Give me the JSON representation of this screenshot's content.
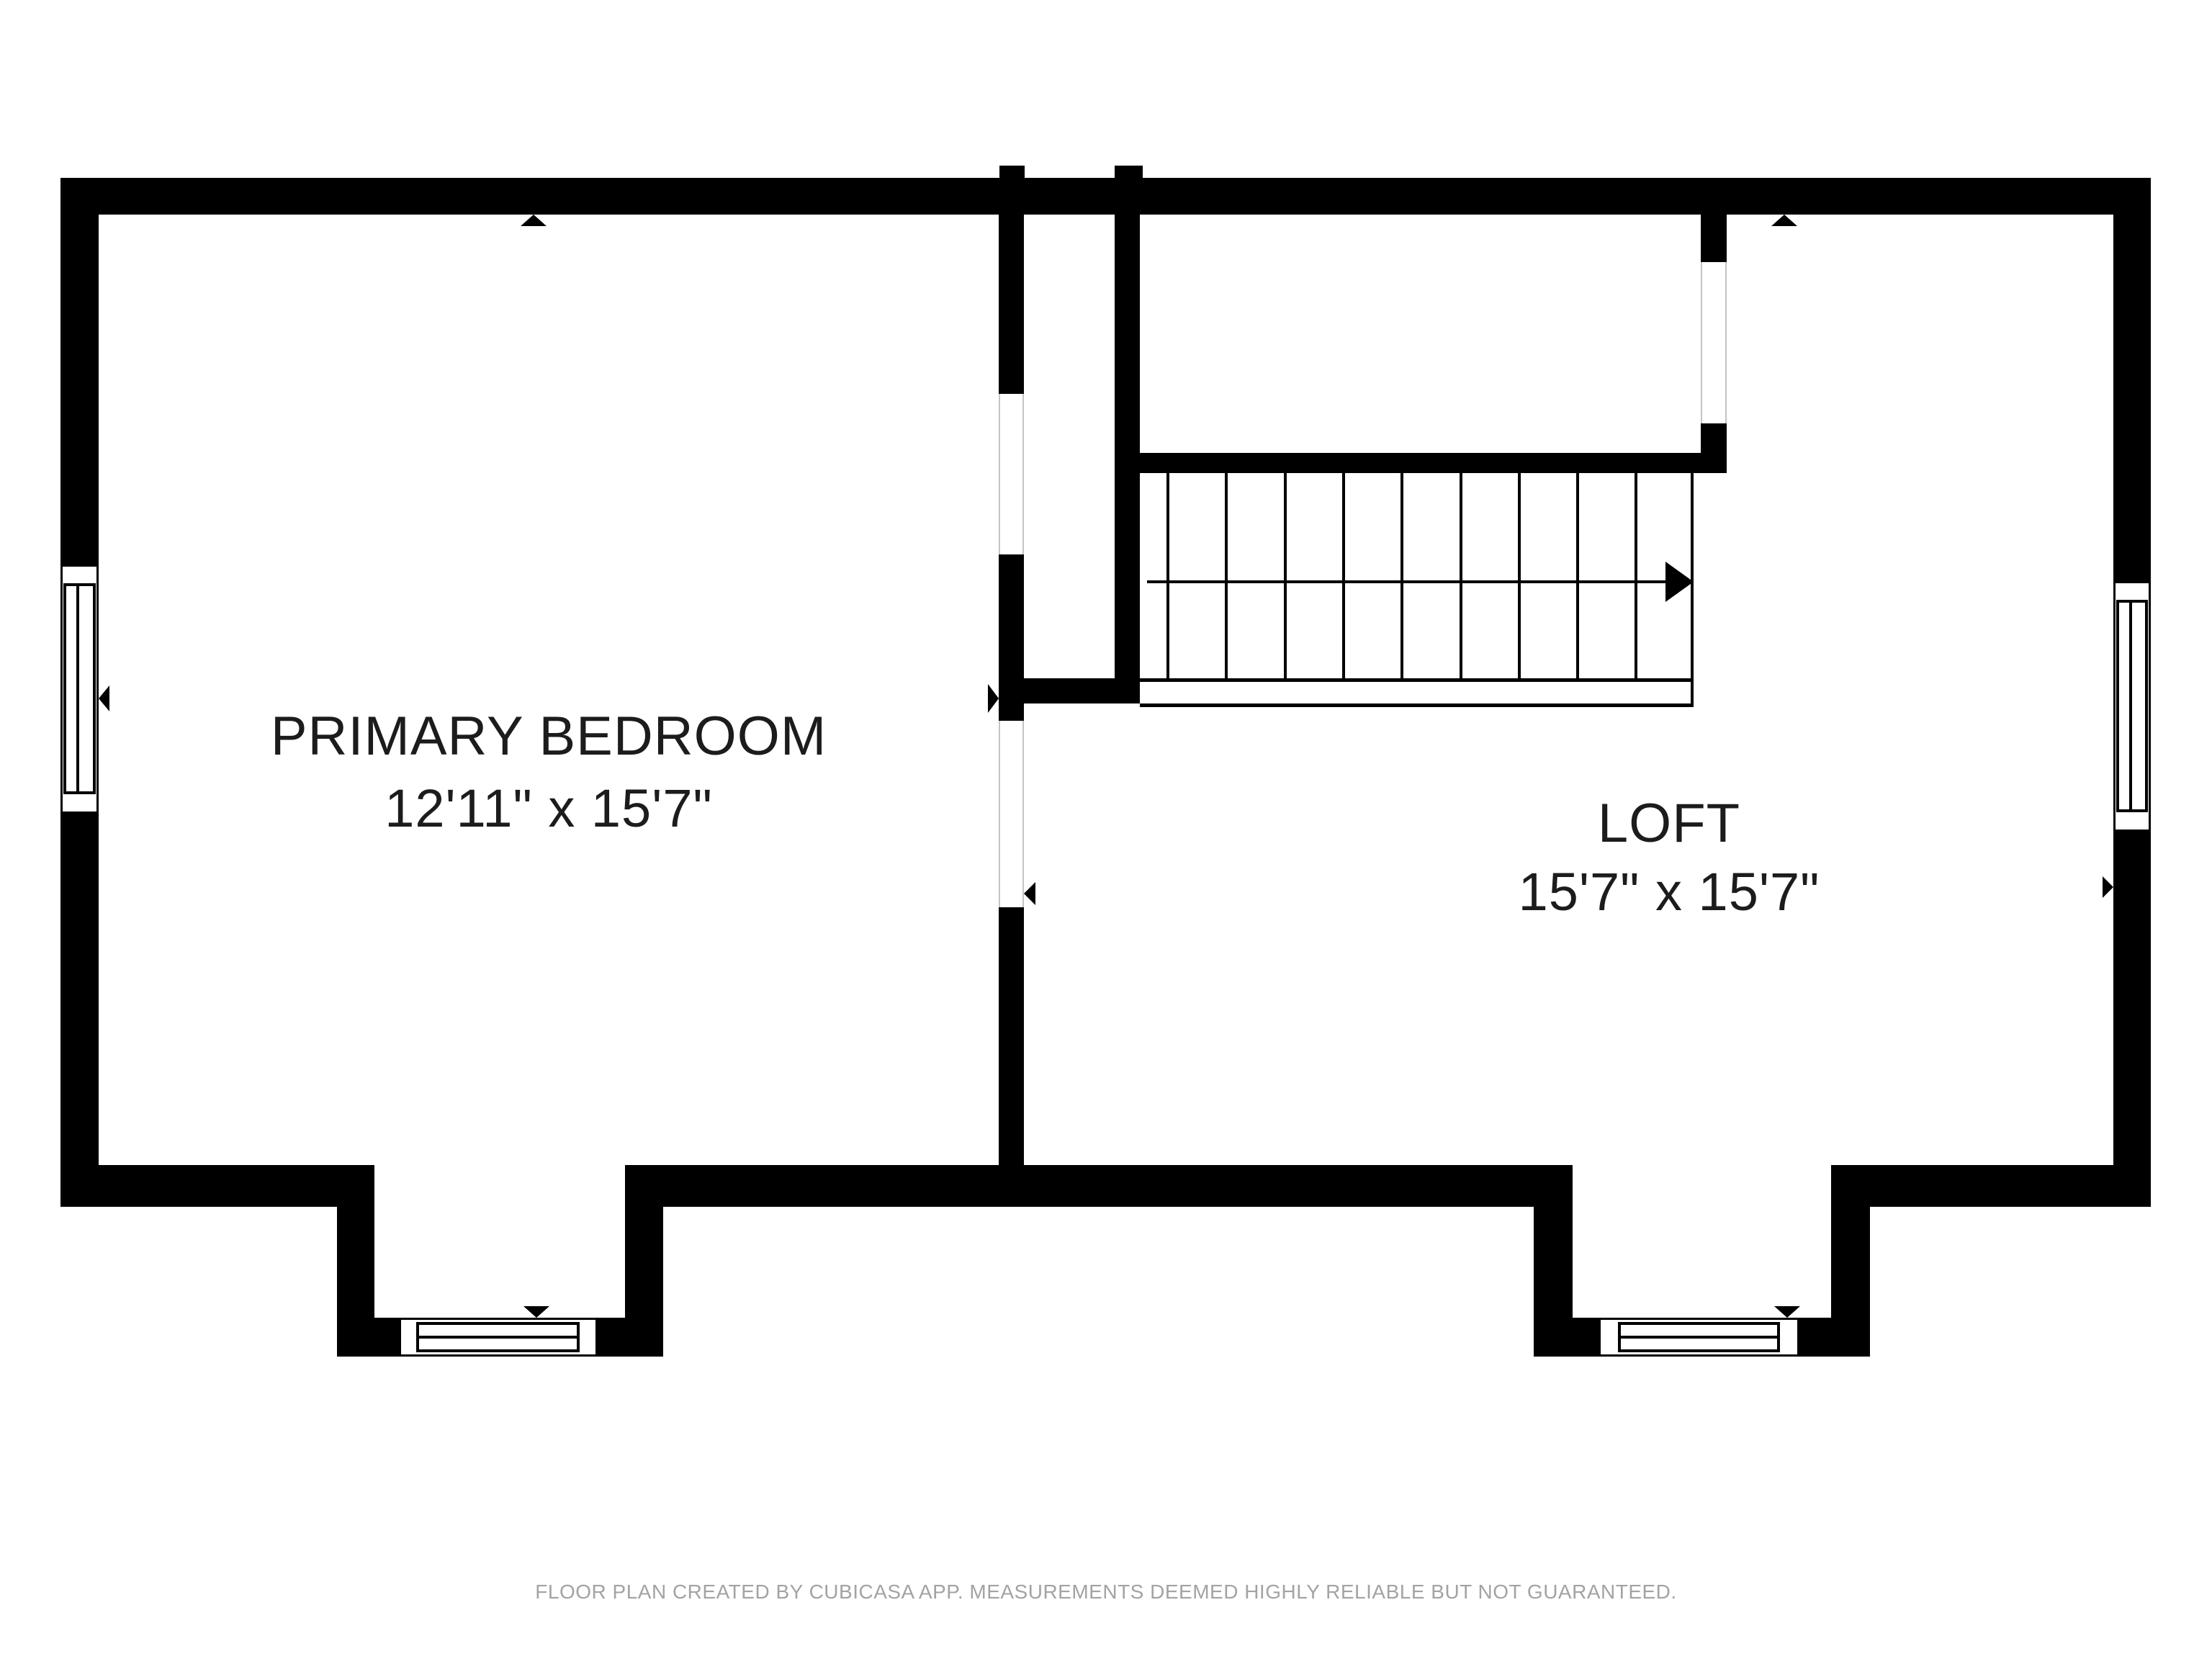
{
  "title": "Floor plan - upper floor",
  "rooms": [
    {
      "name": "PRIMARY BEDROOM",
      "dims": "12'11\" x 15'7\""
    },
    {
      "name": "LOFT",
      "dims": "15'7\" x 15'7\""
    }
  ],
  "stairs": {
    "tread_count": 10,
    "direction_arrow": "right"
  },
  "windows": [
    {
      "location": "left-wall"
    },
    {
      "location": "right-wall"
    },
    {
      "location": "bottom-left-bumpout"
    },
    {
      "location": "bottom-right-bumpout"
    }
  ],
  "markers": [
    {
      "type": "triangle",
      "points": "up",
      "at": "top-wall-bedroom"
    },
    {
      "type": "triangle",
      "points": "up",
      "at": "top-wall-loft"
    },
    {
      "type": "triangle",
      "points": "left",
      "at": "left-window"
    },
    {
      "type": "triangle",
      "points": "right",
      "at": "divider-wall-bedroom-side"
    },
    {
      "type": "triangle",
      "points": "left",
      "at": "divider-wall-loft-side"
    },
    {
      "type": "triangle",
      "points": "right",
      "at": "right-wall"
    },
    {
      "type": "triangle",
      "points": "down",
      "at": "bottom-left-window"
    },
    {
      "type": "triangle",
      "points": "down",
      "at": "bottom-right-window"
    }
  ],
  "footer": {
    "text": "FLOOR PLAN CREATED BY CUBICASA APP. MEASUREMENTS DEEMED HIGHLY RELIABLE BUT NOT GUARANTEED."
  },
  "colors": {
    "background": "#ffffff",
    "wall": "#000000",
    "label_text": "#1c1c1c",
    "footer_text": "#a3a3a3",
    "opening_outline": "#c4c4c4"
  }
}
